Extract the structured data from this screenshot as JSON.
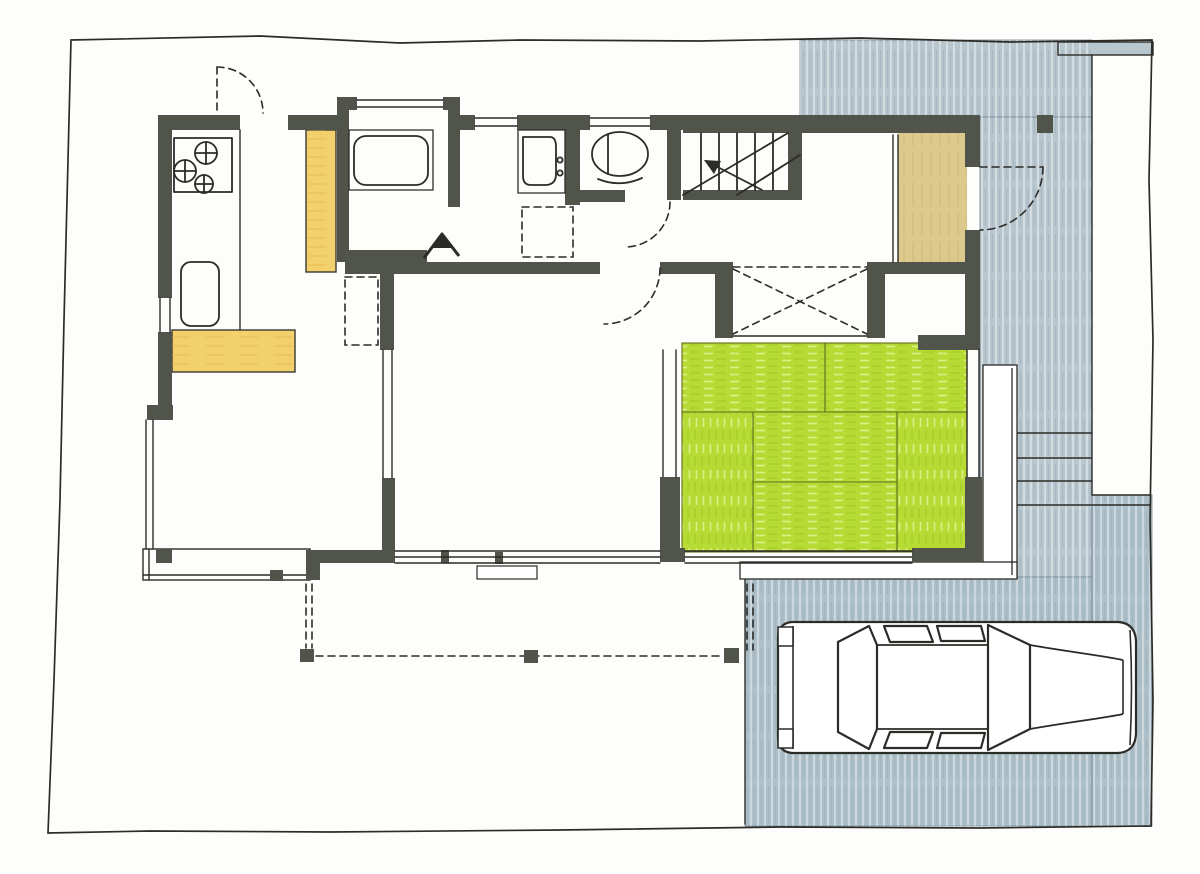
{
  "colors": {
    "paper": "#fdfdfb",
    "ink": "#2b2b27",
    "wall": "#51544b",
    "tatami_green": "#b7da35",
    "counter_yellow": "#f2d06c",
    "entry_tan": "#dcc98e",
    "paving_blue": "#b8c6ce",
    "paving_blue_dark": "#aec0c9"
  },
  "plan": {
    "kind": "hand-drawn house floor plan with site",
    "features": [
      {
        "name": "property-boundary"
      },
      {
        "name": "paved-entrance-approach"
      },
      {
        "name": "parking-space"
      },
      {
        "name": "car-top-view"
      },
      {
        "name": "entrance-genkan"
      },
      {
        "name": "entrance-door-swing"
      },
      {
        "name": "staircase",
        "treads": 6
      },
      {
        "name": "toilet"
      },
      {
        "name": "washbasin"
      },
      {
        "name": "bathtub"
      },
      {
        "name": "washing-machine-pads",
        "count": 2
      },
      {
        "name": "kitchen-stove",
        "burners": 3
      },
      {
        "name": "kitchen-sink"
      },
      {
        "name": "kitchen-counter"
      },
      {
        "name": "refrigerator-space"
      },
      {
        "name": "closet-with-cross"
      },
      {
        "name": "tatami-room",
        "mats": 6
      },
      {
        "name": "engawa-veranda",
        "count": 2
      },
      {
        "name": "wood-deck"
      },
      {
        "name": "eave-outline-posts",
        "count": 3
      },
      {
        "name": "exterior-steps",
        "count": 4
      },
      {
        "name": "door-swing-arcs",
        "count": 4
      }
    ]
  }
}
